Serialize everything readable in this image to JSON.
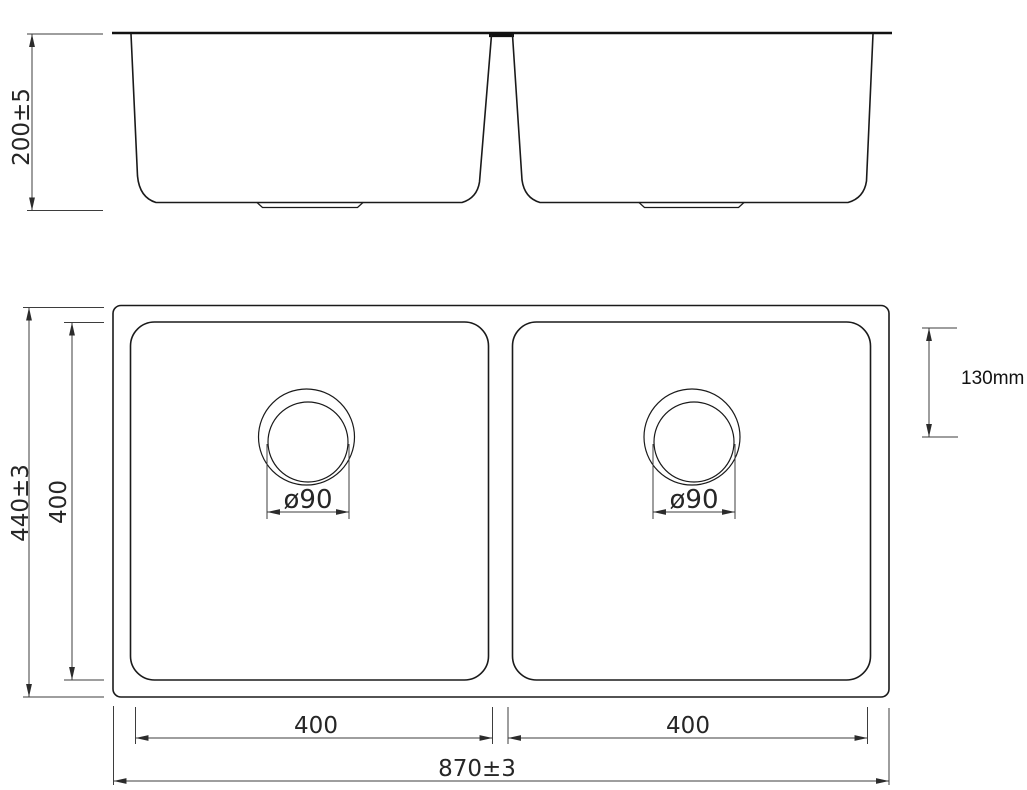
{
  "drawing": {
    "background": "#ffffff",
    "object_line_color": "#1a1a1a",
    "dimension_line_color": "#3d3d3d"
  },
  "front_view": {
    "height_dim": "200±5"
  },
  "plan_view": {
    "overall_width_dim": "870±3",
    "overall_depth_dim": "440±3",
    "bowl_depth_dim": "400",
    "left_bowl_width_dim": "400",
    "right_bowl_width_dim": "400",
    "left_drain_dim": "ø90",
    "right_drain_dim": "ø90",
    "drain_offset_dim": "130mm"
  }
}
